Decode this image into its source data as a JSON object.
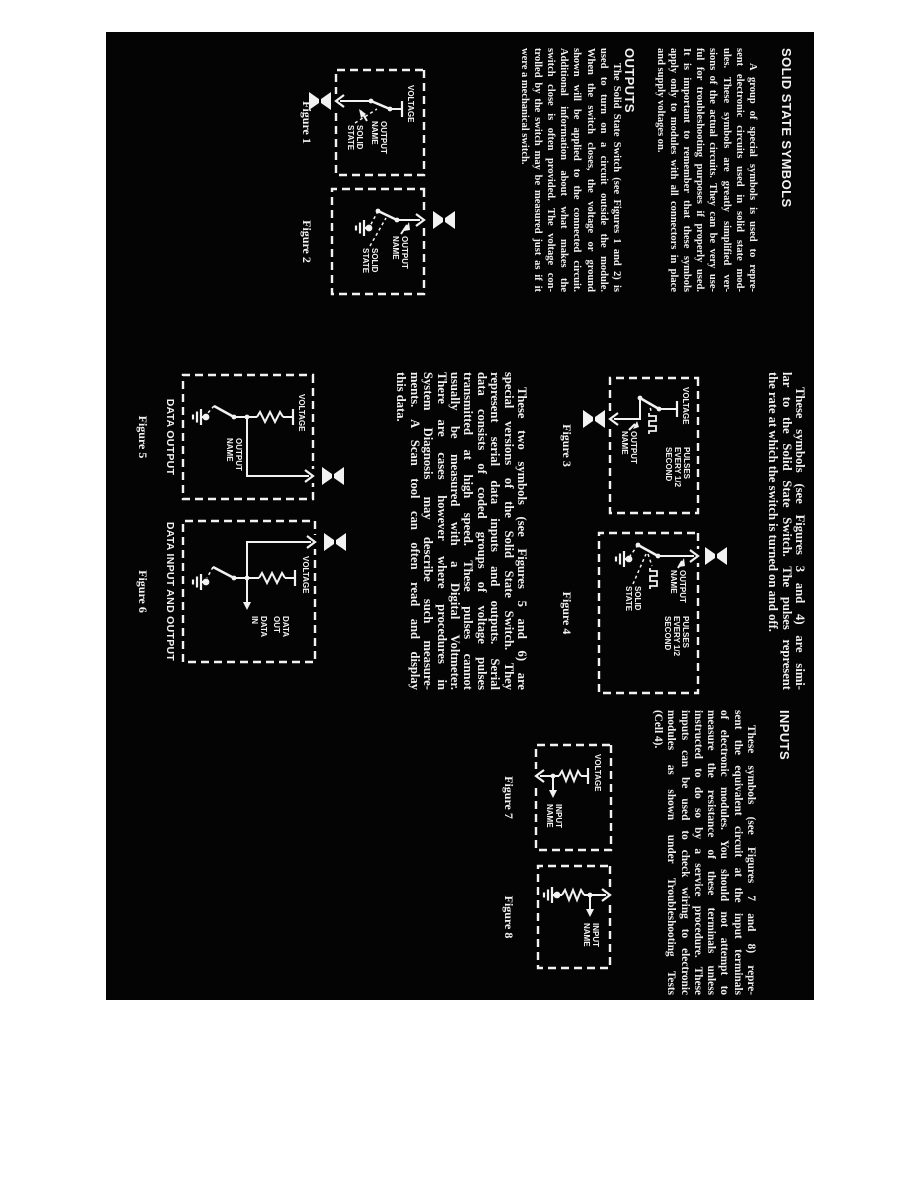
{
  "colors": {
    "paper": "#040404",
    "ink": "#f2f2f2",
    "margin": "#ffffff"
  },
  "sections": {
    "solid_state": {
      "heading": "SOLID STATE SYMBOLS",
      "para": [
        "A group of special symbols is used to repre-",
        "sent electronic circuits used in solid state mod-",
        "ules. These symbols are greatly simplified ver-",
        "sions of the actual circuits. They can be very use-",
        "ful for troubleshooting purposes if properly used.",
        "It is important to remember that these symbols",
        "apply only to modules with all connectors in place",
        "and supply voltages on."
      ]
    },
    "outputs": {
      "heading": "OUTPUTS",
      "para": [
        "The Solid State Switch (see Figures 1 and 2) is",
        "used to turn on a circuit outside the module.",
        "When the switch closes, the voltage or ground",
        "shown will be applied to the connected circuit.",
        "Additional information about what makes the",
        "switch close is often provided. The voltage con-",
        "trolled by the switch may be measured just as if it",
        "were a mechanical switch."
      ]
    },
    "pulsed": {
      "para": [
        "These symbols (see Figures 3 and 4) are simi-",
        "lar to the Solid State Switch. The pulses represent",
        "the rate at which the switch is turned on and off."
      ]
    },
    "serial_data": {
      "para": [
        "These two symbols (see Figures 5 and 6) are",
        "special versions of the Solid State Switch. They",
        "represent serial data inputs and outputs. Serial",
        "data consists of coded groups of voltage pulses",
        "transmitted at high speed. These pulses cannot",
        "usually be measured with a Digital Voltmeter.",
        "There are cases however where procedures in",
        "System Diagnosis may describe such measure-",
        "ments. A Scan tool can often read and display",
        "this data."
      ]
    },
    "inputs": {
      "heading": "INPUTS",
      "para": [
        "These symbols (see Figures 7 and 8) repre-",
        "sent the equivalent circuit at the input terminals",
        "of electronic modules. You should not attempt to",
        "measure the resistance of these terminals unless",
        "instructed to do so by a service procedure. These",
        "inputs can be used to check wiring to electronic",
        "modules as shown under Troubleshooting Tests",
        "(Cell 4)."
      ]
    }
  },
  "figures": {
    "fig1": {
      "caption": "Figure 1",
      "voltage": "VOLTAGE",
      "output_name": [
        "OUTPUT",
        "NAME"
      ],
      "solid_state": [
        "SOLID",
        "STATE"
      ]
    },
    "fig2": {
      "caption": "Figure 2",
      "output_name": [
        "OUTPUT",
        "NAME"
      ],
      "solid_state": [
        "SOLID",
        "STATE"
      ]
    },
    "fig3": {
      "caption": "Figure 3",
      "voltage": "VOLTAGE",
      "pulses": [
        "PULSES",
        "EVERY 1/2",
        "SECOND"
      ],
      "output_name": [
        "OUTPUT",
        "NAME"
      ]
    },
    "fig4": {
      "caption": "Figure 4",
      "output_name": [
        "OUTPUT",
        "NAME"
      ],
      "pulses": [
        "PULSES",
        "EVERY 1/2",
        "SECOND"
      ],
      "solid_state": [
        "SOLID",
        "STATE"
      ]
    },
    "fig5": {
      "title": "DATA OUTPUT",
      "caption": "Figure 5",
      "voltage": "VOLTAGE",
      "output_name": [
        "OUTPUT",
        "NAME"
      ]
    },
    "fig6": {
      "title": "DATA INPUT AND OUTPUT",
      "caption": "Figure 6",
      "voltage": "VOLTAGE",
      "data_out": [
        "DATA",
        "OUT"
      ],
      "data_in": [
        "DATA",
        "IN"
      ]
    },
    "fig7": {
      "caption": "Figure 7",
      "voltage": "VOLTAGE",
      "input_name": [
        "INPUT",
        "NAME"
      ]
    },
    "fig8": {
      "caption": "Figure 8",
      "input_name": [
        "INPUT",
        "NAME"
      ]
    }
  }
}
